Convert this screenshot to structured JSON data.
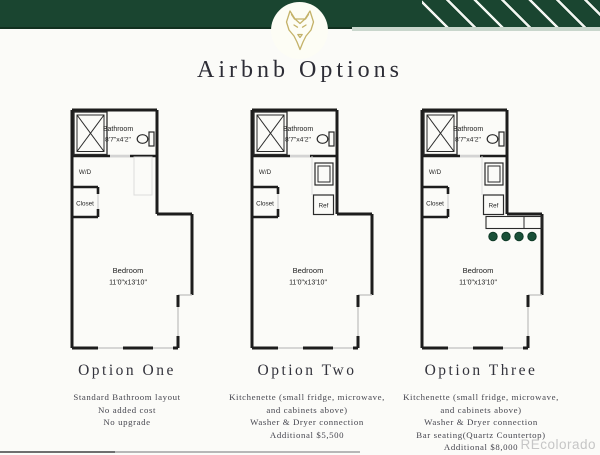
{
  "title": "Airbnb Options",
  "watermark": "REcolorado",
  "header": {
    "band_color": "#1a4530",
    "stripe_color": "#f3f6f1",
    "accent_strip_color": "#c9d6cc",
    "logo_icon": "wolf-icon",
    "logo_color": "#c4b269"
  },
  "plan_colors": {
    "wall": "#1d1d1d",
    "window": "#c9c9c9",
    "door": "#d4d4d4",
    "guide": "#dcdcdc"
  },
  "plans": [
    {
      "name": "Option One",
      "labels": {
        "bathroom": "Bathroom",
        "bathroom_dims": "8'7\"x4'2\"",
        "washer_dryer": "W/D",
        "closet": "Closet",
        "bedroom": "Bedroom",
        "bedroom_dims": "11'0\"x13'10\""
      },
      "kitchenette": false,
      "bar_seating": false,
      "description": [
        "Standard Bathroom layout",
        "No added cost",
        "No upgrade"
      ]
    },
    {
      "name": "Option Two",
      "labels": {
        "bathroom": "Bathroom",
        "bathroom_dims": "8'7\"x4'2\"",
        "washer_dryer": "W/D",
        "closet": "Closet",
        "fridge": "Ref",
        "bedroom": "Bedroom",
        "bedroom_dims": "11'0\"x13'10\""
      },
      "kitchenette": true,
      "bar_seating": false,
      "description": [
        "Kitchenette (small fridge, microwave,",
        "and cabinets above)",
        "Washer & Dryer connection",
        "Additional $5,500"
      ]
    },
    {
      "name": "Option Three",
      "labels": {
        "bathroom": "Bathroom",
        "bathroom_dims": "8'7\"x4'2\"",
        "washer_dryer": "W/D",
        "closet": "Closet",
        "fridge": "Ref",
        "bedroom": "Bedroom",
        "bedroom_dims": "11'0\"x13'10\""
      },
      "kitchenette": true,
      "bar_seating": true,
      "stool_color": "#1a5038",
      "description": [
        "Kitchenette (small fridge, microwave,",
        "and cabinets above)",
        "Washer & Dryer connection",
        "Bar seating(Quartz Countertop)",
        "Additional $8,000"
      ]
    }
  ]
}
